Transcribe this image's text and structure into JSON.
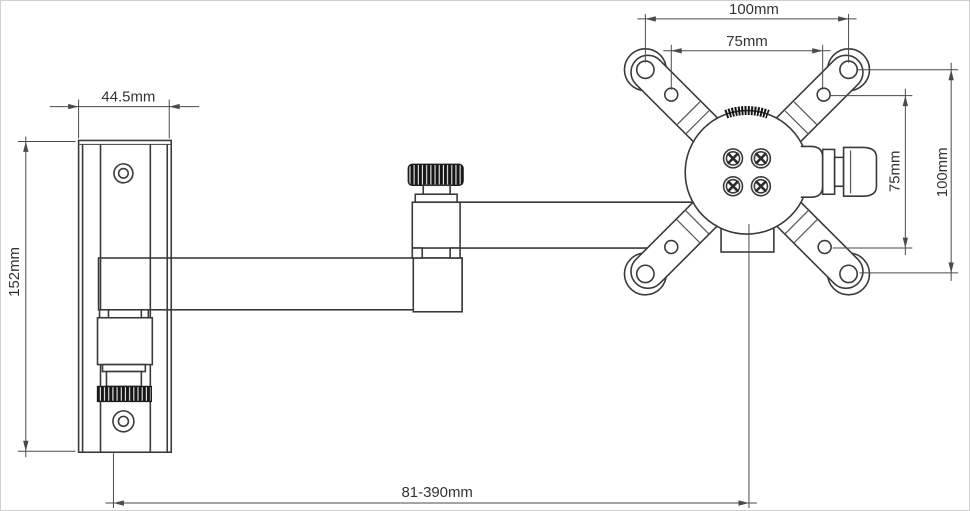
{
  "diagram": {
    "title": "Monitor wall-mount bracket technical drawing",
    "type": "dimensioned-line-drawing",
    "dimensions": {
      "wall_plate_width": "44.5mm",
      "wall_plate_height": "152mm",
      "vesa_outer_width": "100mm",
      "vesa_inner_width": "75mm",
      "vesa_inner_height": "75mm",
      "vesa_outer_height": "100mm",
      "arm_reach": "81-390mm"
    },
    "colors": {
      "line": "#3a3a3a",
      "dimension_line": "#4a4a4a",
      "knurl_dark": "#161616",
      "background": "#ffffff"
    }
  }
}
